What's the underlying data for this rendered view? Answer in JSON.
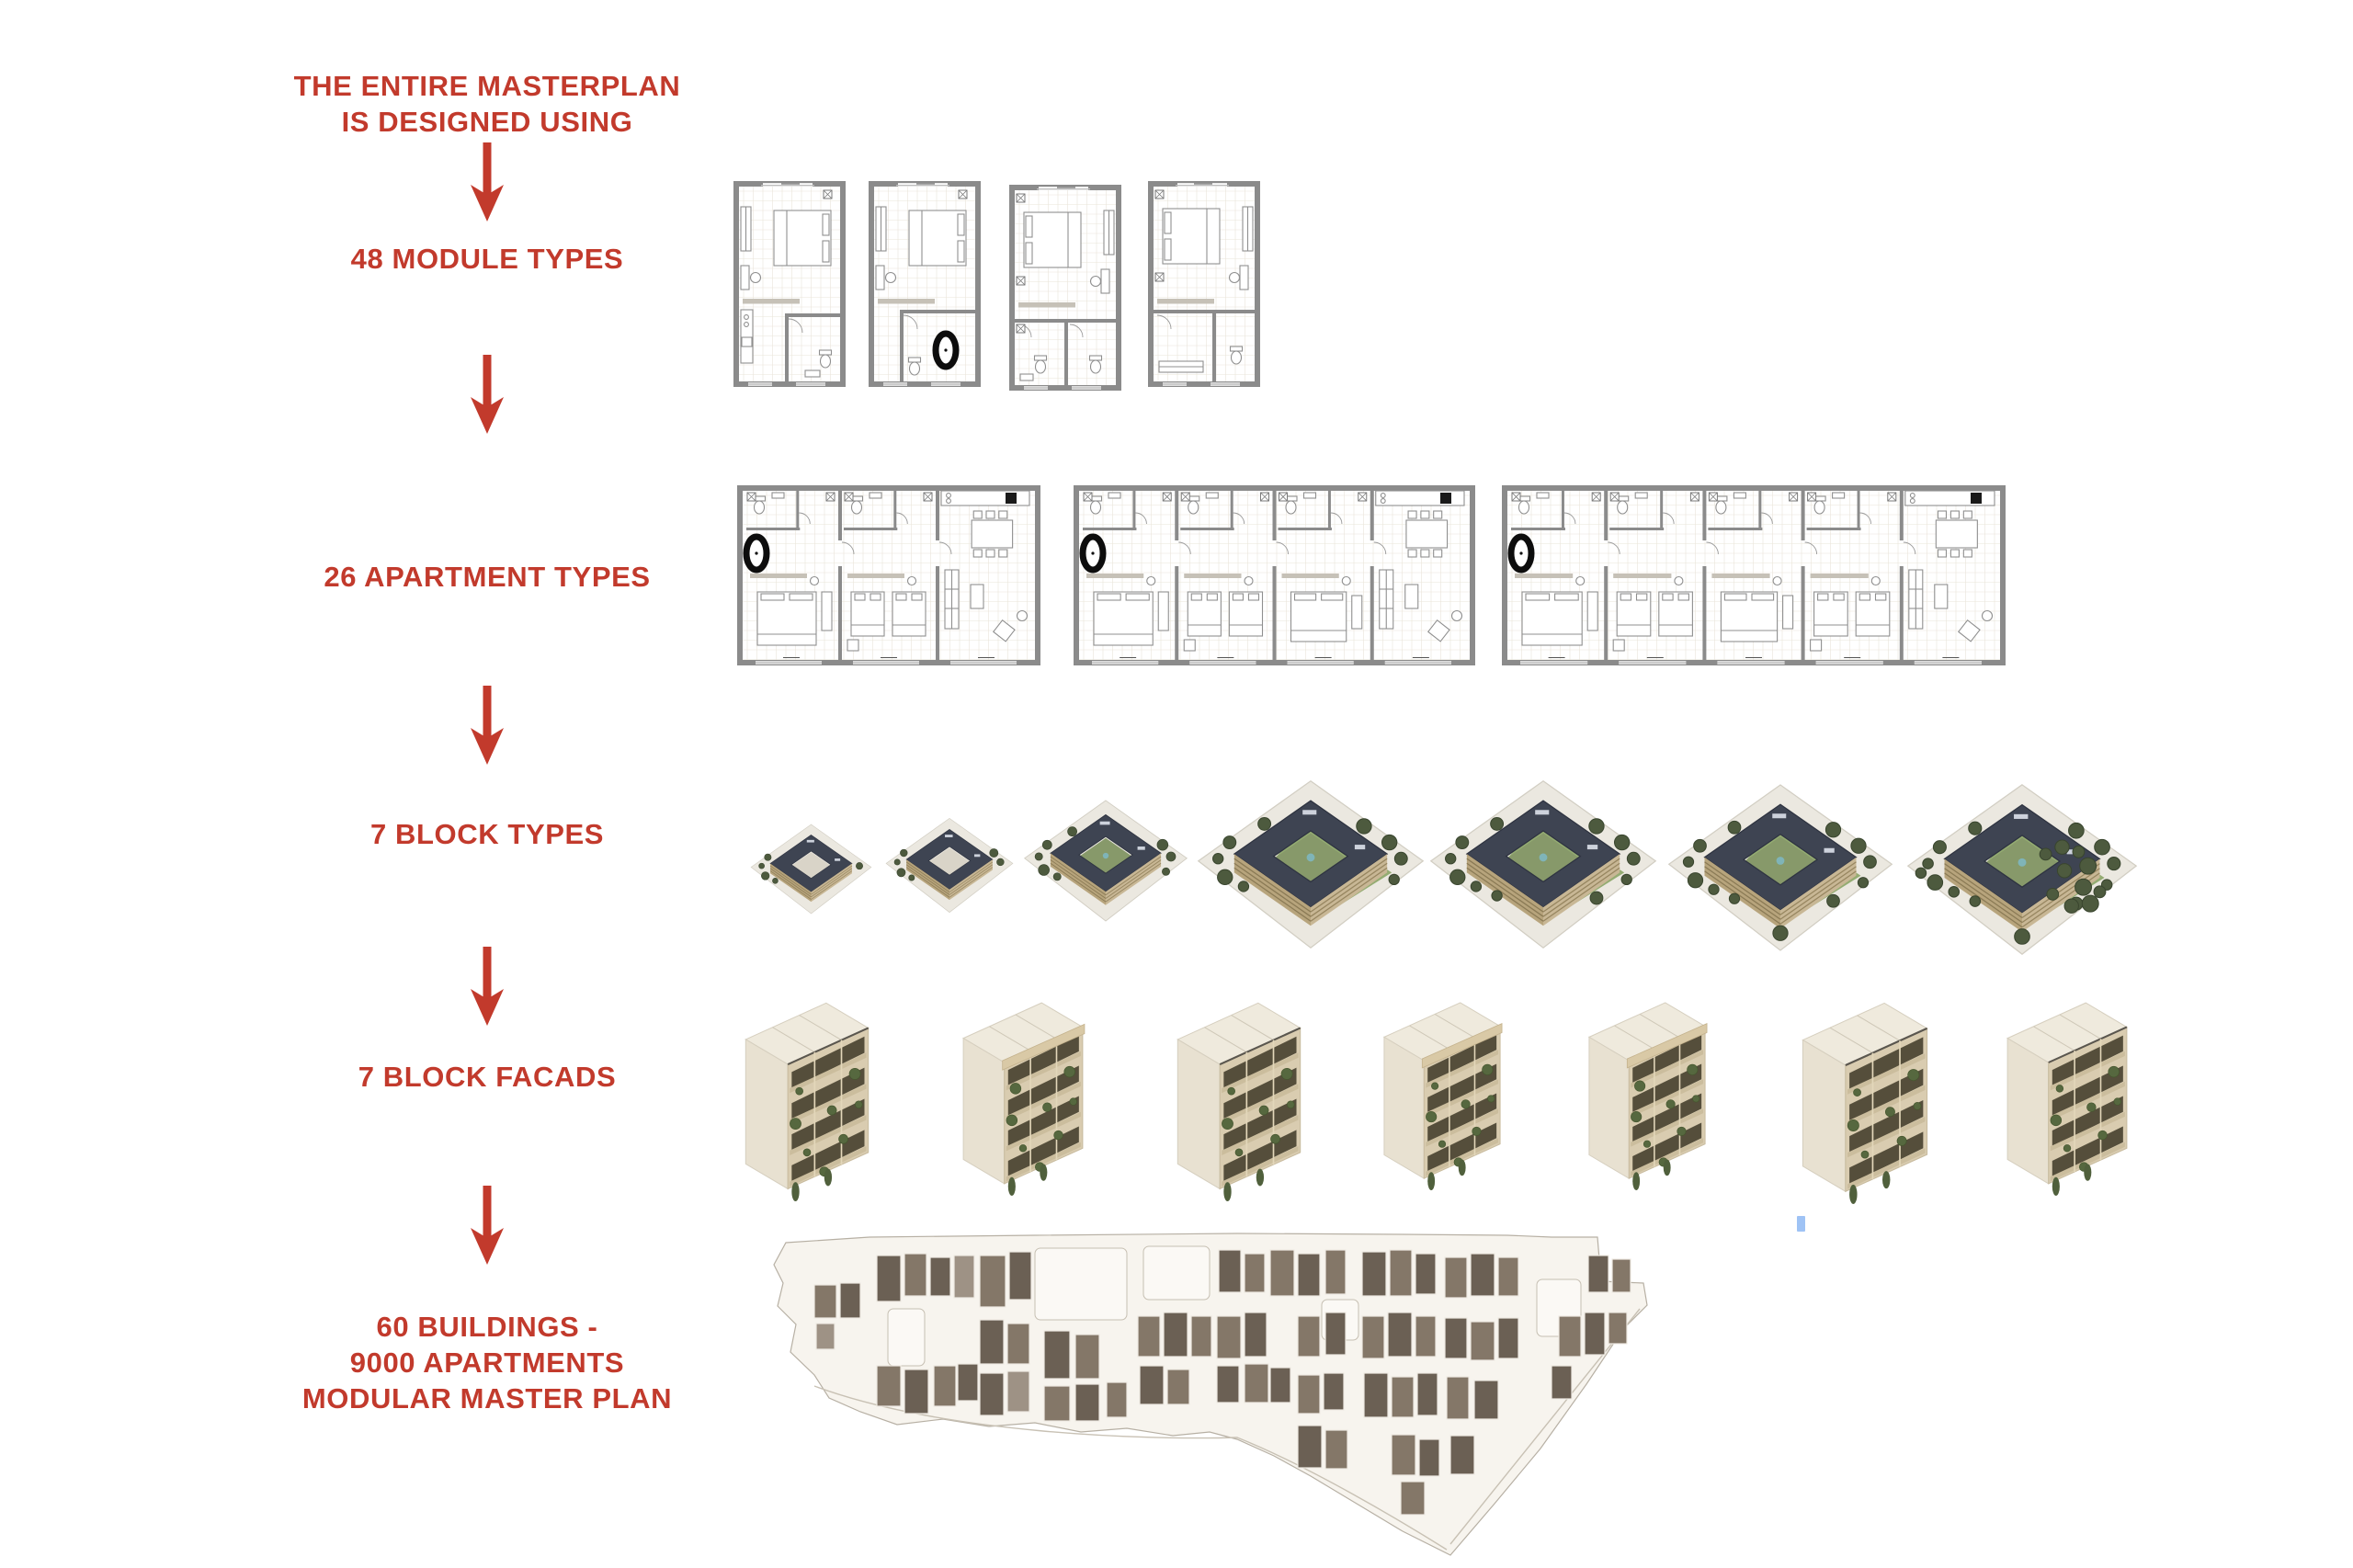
{
  "page": {
    "background": "#ffffff",
    "accent": "#c23a2c",
    "cursor_artifact_color": "#9fc3f5"
  },
  "flow": {
    "intro_line1": "THE ENTIRE MASTERPLAN",
    "intro_line2": "IS DESIGNED USING",
    "steps": [
      {
        "id": "modules",
        "label": "48 MODULE TYPES",
        "count": 48,
        "examples_shown": 4
      },
      {
        "id": "apartments",
        "label": "26 APARTMENT TYPES",
        "count": 26,
        "examples_shown": 3
      },
      {
        "id": "blocks",
        "label": "7 BLOCK TYPES",
        "count": 7,
        "examples_shown": 7
      },
      {
        "id": "facades",
        "label": "7 BLOCK FACADS",
        "count": 7,
        "examples_shown": 7
      }
    ],
    "result_line1": "60 BUILDINGS -",
    "result_line2": "9000 APARTMENTS",
    "result_line3": "MODULAR MASTER PLAN"
  },
  "graphics": {
    "module_plans": [
      "module-plan-1",
      "module-plan-2",
      "module-plan-3",
      "module-plan-4"
    ],
    "apartment_plans": [
      {
        "name": "apartment-plan-1",
        "modules": 3
      },
      {
        "name": "apartment-plan-2",
        "modules": 4
      },
      {
        "name": "apartment-plan-3",
        "modules": 5
      }
    ],
    "block_types": [
      "block-type-1",
      "block-type-2",
      "block-type-3",
      "block-type-4",
      "block-type-5",
      "block-type-6",
      "block-type-7"
    ],
    "block_facades": [
      "block-facade-1",
      "block-facade-2",
      "block-facade-3",
      "block-facade-4",
      "block-facade-5",
      "block-facade-6",
      "block-facade-7"
    ],
    "master_plan": "modular-master-plan-map",
    "palette": {
      "plan_wall": "#8b8b8b",
      "roof": "#3e4452",
      "building_tan": "#c8b795",
      "lawn": "#8ba566",
      "tree": "#4d5a3e",
      "facade_cream": "#efeadd",
      "map_ground": "#f7f4ee",
      "map_building_dark": "#6b6054",
      "map_building_mid": "#847768",
      "map_building_light": "#9e9285"
    }
  }
}
